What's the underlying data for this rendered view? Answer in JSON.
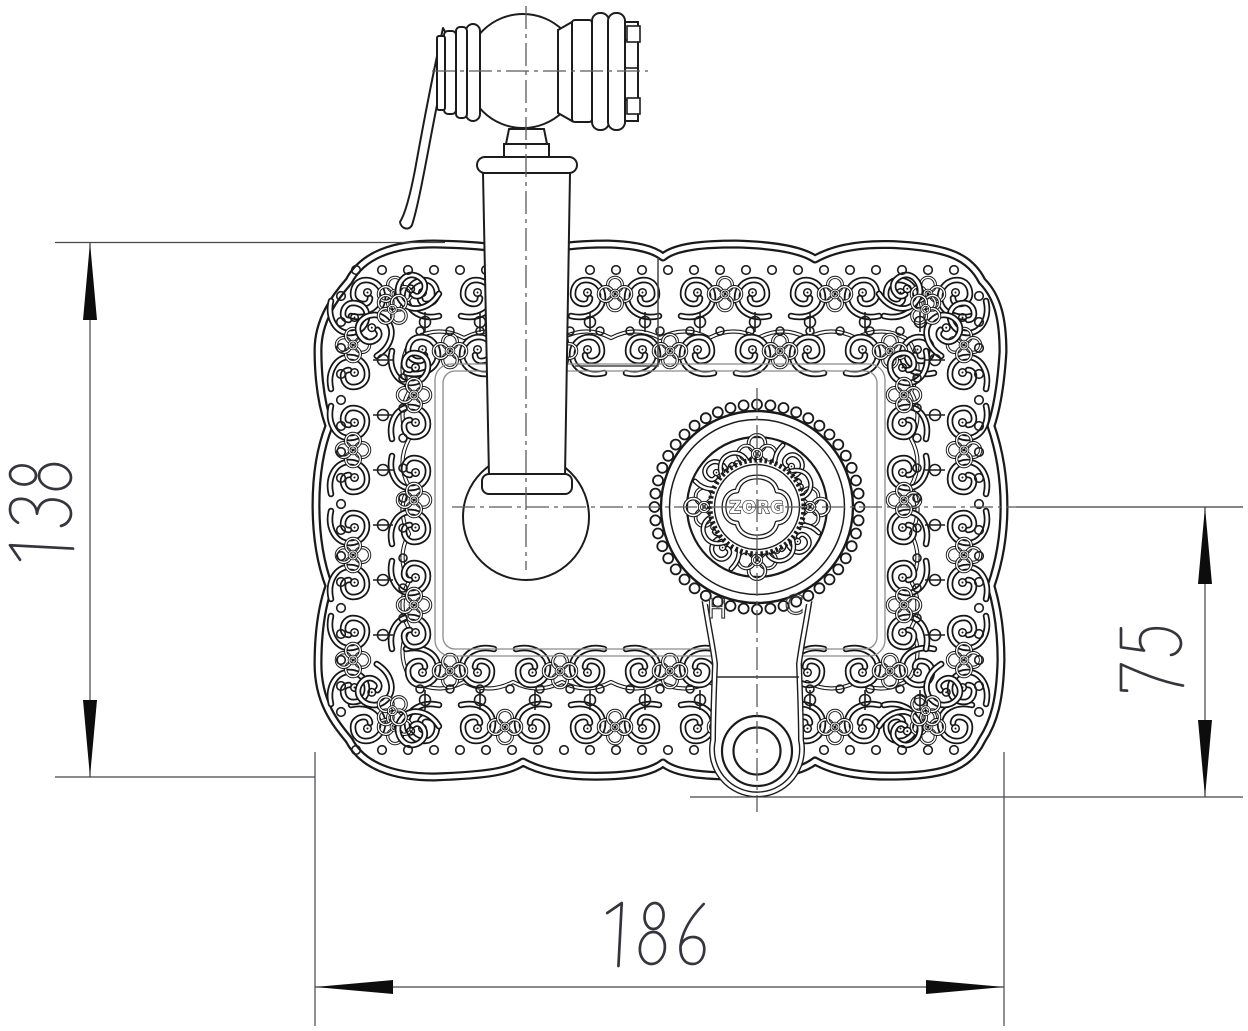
{
  "drawing": {
    "brand_label": "ZORG",
    "hot_label": "H",
    "cold_label": "C",
    "dim_height": "138",
    "dim_offset": "75",
    "dim_width": "186"
  },
  "colors": {
    "line": "#1c1c1c",
    "ornament": "#161616",
    "construction": "#5b5b5b",
    "dimension_text": "#35353e",
    "background": "#ffffff"
  }
}
